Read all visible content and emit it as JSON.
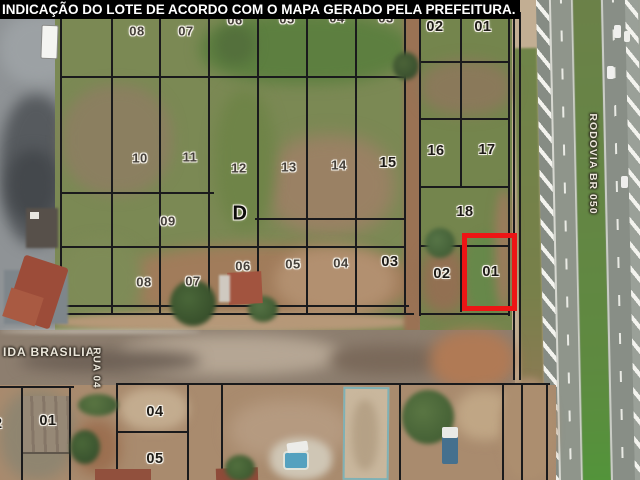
{
  "title_bar": {
    "text": "INDICAÇÃO DO LOTE DE ACORDO COM O MAPA GERADO PELA PREFEITURA."
  },
  "map": {
    "kind": "aerial-cadastral-map",
    "highlight": {
      "lot": "01",
      "color": "#ed1515"
    },
    "streets": [
      {
        "id": "avenida-brasilia",
        "name": "IDA BRASILIA",
        "x": 3,
        "y": 352,
        "rot": 0,
        "size": 12,
        "anchor": "left"
      },
      {
        "id": "rua-04",
        "name": "RUA 04",
        "x": 96,
        "y": 368,
        "rot": 90,
        "size": 10,
        "anchor": "center"
      },
      {
        "id": "rodovia-br-050",
        "name": "RODOVIA BR 050",
        "x": 593,
        "y": 164,
        "rot": 90,
        "size": 10.5,
        "anchor": "center"
      }
    ],
    "lots": [
      {
        "n": "08",
        "x": 137,
        "y": 31,
        "s": "plain"
      },
      {
        "n": "07",
        "x": 186,
        "y": 31,
        "s": "plain"
      },
      {
        "n": "06",
        "x": 235,
        "y": 20,
        "s": "plain"
      },
      {
        "n": "05",
        "x": 287,
        "y": 19,
        "s": "plain"
      },
      {
        "n": "04",
        "x": 337,
        "y": 18,
        "s": "plain"
      },
      {
        "n": "03",
        "x": 386,
        "y": 18,
        "s": "plain"
      },
      {
        "n": "02",
        "x": 435,
        "y": 27,
        "s": "bold"
      },
      {
        "n": "01",
        "x": 483,
        "y": 27,
        "s": "bold"
      },
      {
        "n": "10",
        "x": 140,
        "y": 158,
        "s": "plain"
      },
      {
        "n": "11",
        "x": 190,
        "y": 157,
        "s": "plain"
      },
      {
        "n": "12",
        "x": 239,
        "y": 168,
        "s": "plain"
      },
      {
        "n": "13",
        "x": 289,
        "y": 167,
        "s": "plain"
      },
      {
        "n": "14",
        "x": 339,
        "y": 165,
        "s": "plain"
      },
      {
        "n": "15",
        "x": 388,
        "y": 163,
        "s": "bold"
      },
      {
        "n": "16",
        "x": 436,
        "y": 151,
        "s": "bold"
      },
      {
        "n": "17",
        "x": 487,
        "y": 150,
        "s": "bold"
      },
      {
        "n": "09",
        "x": 168,
        "y": 221,
        "s": "plain"
      },
      {
        "n": "D",
        "x": 240,
        "y": 214,
        "s": "letter"
      },
      {
        "n": "18",
        "x": 465,
        "y": 212,
        "s": "bold"
      },
      {
        "n": "08",
        "x": 144,
        "y": 282,
        "s": "plain"
      },
      {
        "n": "07",
        "x": 193,
        "y": 281,
        "s": "plain"
      },
      {
        "n": "06",
        "x": 243,
        "y": 266,
        "s": "plain"
      },
      {
        "n": "05",
        "x": 293,
        "y": 264,
        "s": "plain"
      },
      {
        "n": "04",
        "x": 341,
        "y": 263,
        "s": "plain"
      },
      {
        "n": "03",
        "x": 390,
        "y": 262,
        "s": "bold"
      },
      {
        "n": "02",
        "x": 442,
        "y": 274,
        "s": "bold"
      },
      {
        "n": "01",
        "x": 491,
        "y": 272,
        "s": "bold"
      },
      {
        "n": "02",
        "x": -6,
        "y": 424,
        "s": "bold"
      },
      {
        "n": "01",
        "x": 48,
        "y": 421,
        "s": "bold"
      },
      {
        "n": "04",
        "x": 155,
        "y": 412,
        "s": "bold"
      },
      {
        "n": "05",
        "x": 155,
        "y": 459,
        "s": "bold"
      }
    ]
  }
}
